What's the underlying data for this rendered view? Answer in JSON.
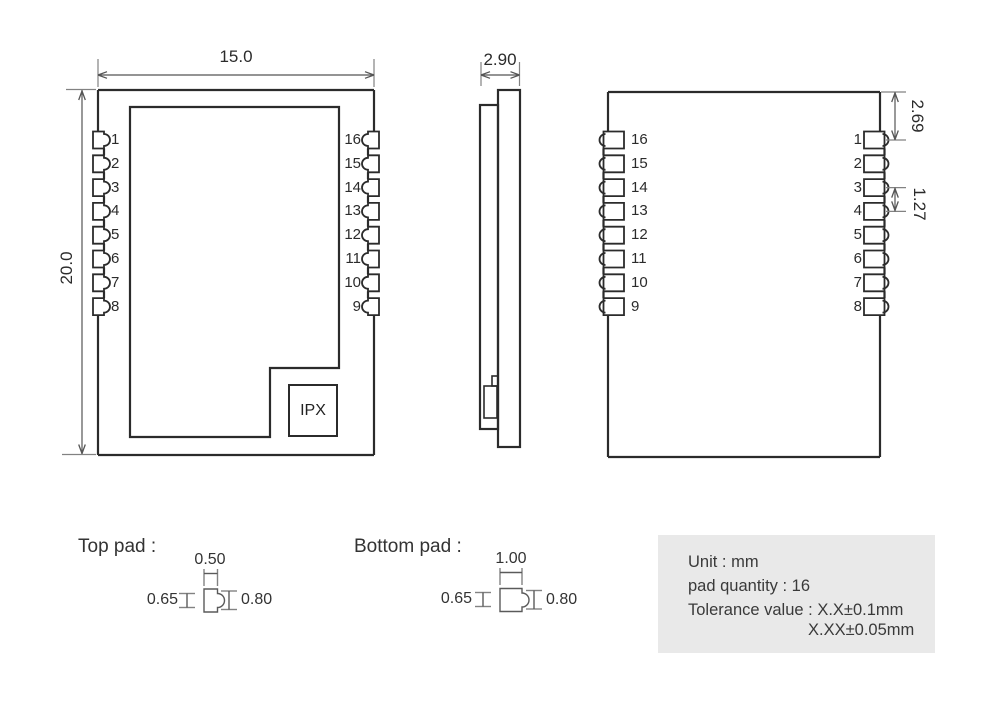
{
  "colors": {
    "body_line": "#2b2b2b",
    "dim_line": "#555555",
    "tick_line": "#828282",
    "detail_line": "#5a5a5a",
    "infobox_bg": "#e9e9e9",
    "text": "#333333"
  },
  "top_view": {
    "width_dim": "15.0",
    "height_dim": "20.0",
    "ipx_label": "IPX",
    "left_pins": [
      "1",
      "2",
      "3",
      "4",
      "5",
      "6",
      "7",
      "8"
    ],
    "right_pins": [
      "16",
      "15",
      "14",
      "13",
      "12",
      "11",
      "10",
      "9"
    ]
  },
  "side_view": {
    "thickness_dim": "2.90"
  },
  "bottom_view": {
    "left_pins": [
      "16",
      "15",
      "14",
      "13",
      "12",
      "11",
      "10",
      "9"
    ],
    "right_pins": [
      "1",
      "2",
      "3",
      "4",
      "5",
      "6",
      "7",
      "8"
    ],
    "top_clearance_dim": "2.69",
    "pitch_dim": "1.27"
  },
  "pad_details": {
    "top_pad": {
      "title": "Top pad :",
      "width": "0.50",
      "left_height": "0.65",
      "right_height": "0.80"
    },
    "bottom_pad": {
      "title": "Bottom pad :",
      "width": "1.00",
      "left_height": "0.65",
      "right_height": "0.80"
    }
  },
  "info_box": {
    "unit": "Unit : mm",
    "pad_quantity": "pad quantity : 16",
    "tolerance1": "Tolerance value : X.X±0.1mm",
    "tolerance2": "X.XX±0.05mm"
  }
}
